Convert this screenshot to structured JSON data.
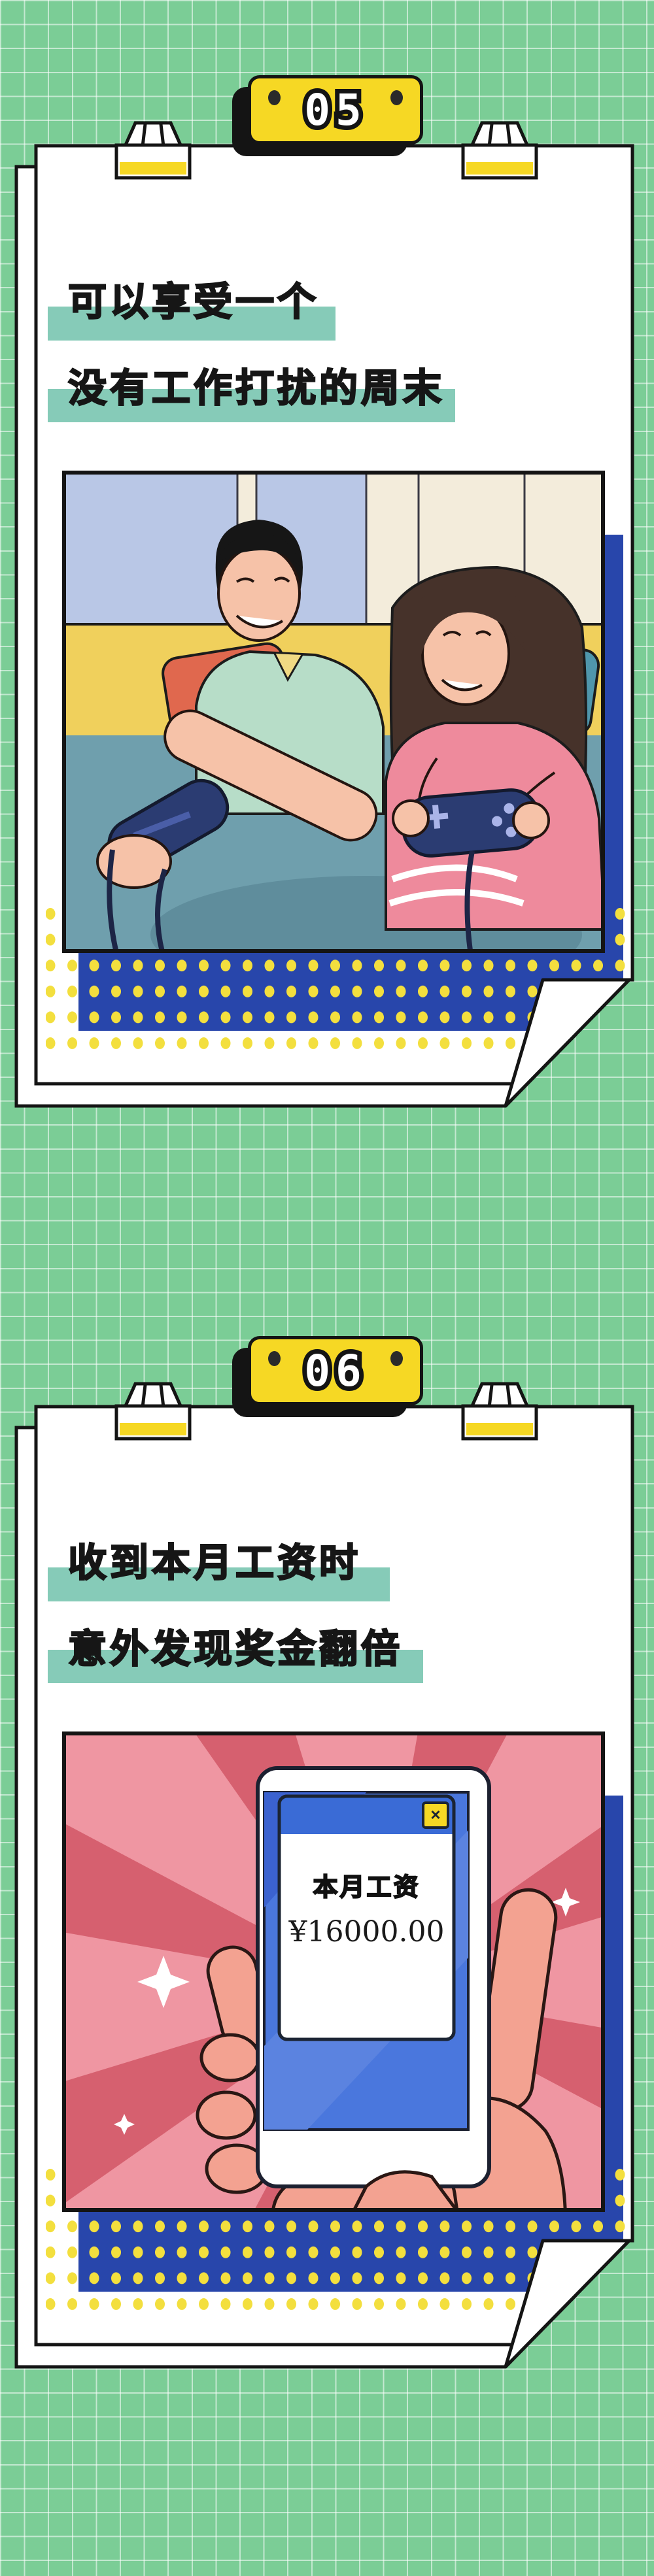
{
  "page": {
    "background_color": "#7bcd96",
    "grid_line_color": "#ffffff"
  },
  "cards": [
    {
      "badge_number": "05",
      "title_line1": "可以享受一个",
      "title_line2": "没有工作打扰的周末",
      "illustration": "couple-lying-on-bed-playing-video-game-controllers"
    },
    {
      "badge_number": "06",
      "title_line1": "收到本月工资时",
      "title_line2": "意外发现奖金翻倍",
      "illustration": "hand-holding-phone-with-salary-popup",
      "phone_window": {
        "title": "本月工资",
        "amount": "¥16000.00",
        "close_label": "×"
      }
    }
  ],
  "colors": {
    "badge_yellow": "#f6d824",
    "highlight_teal": "#86cbb8",
    "panel_blue": "#2846ab",
    "dot_yellow": "#f3df3e",
    "outline_black": "#141414",
    "burst_pink": "#ef96a2",
    "burst_dark_pink": "#d6606f",
    "screen_blue": "#4a77dd",
    "controller_navy": "#2b3c72"
  }
}
